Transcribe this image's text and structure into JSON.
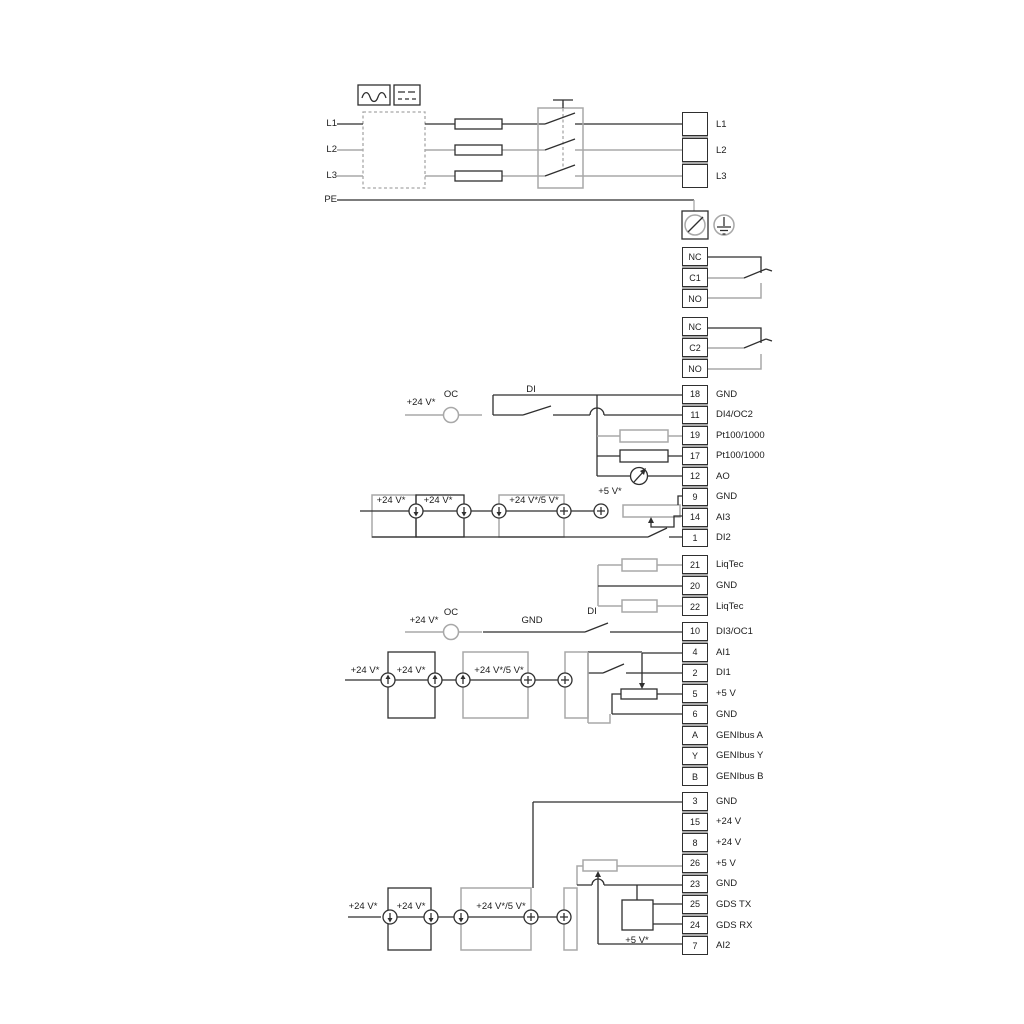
{
  "colors": {
    "line_dark": "#2f2f2f",
    "line_gray": "#a8a8a8"
  },
  "labels": {
    "v24": "+24 V*",
    "v24_5": "+24 V*/5 V*",
    "v5": "+5 V*",
    "oc": "OC",
    "di": "DI",
    "gnd": "GND"
  },
  "power": {
    "inputs": [
      "L1",
      "L2",
      "L3",
      "PE"
    ],
    "outputs": [
      "L1",
      "L2",
      "L3"
    ]
  },
  "relay1": {
    "terminals": [
      "NC",
      "C1",
      "NO"
    ]
  },
  "relay2": {
    "terminals": [
      "NC",
      "C2",
      "NO"
    ]
  },
  "group_a": {
    "terminals": [
      {
        "num": "18",
        "label": "GND"
      },
      {
        "num": "11",
        "label": "DI4/OC2"
      },
      {
        "num": "19",
        "label": "Pt100/1000"
      },
      {
        "num": "17",
        "label": "Pt100/1000"
      },
      {
        "num": "12",
        "label": "AO"
      },
      {
        "num": "9",
        "label": "GND"
      },
      {
        "num": "14",
        "label": "AI3"
      },
      {
        "num": "1",
        "label": "DI2"
      }
    ]
  },
  "group_liqtec": {
    "terminals": [
      {
        "num": "21",
        "label": "LiqTec"
      },
      {
        "num": "20",
        "label": "GND"
      },
      {
        "num": "22",
        "label": "LiqTec"
      }
    ]
  },
  "group_b": {
    "terminals": [
      {
        "num": "10",
        "label": "DI3/OC1"
      },
      {
        "num": "4",
        "label": "AI1"
      },
      {
        "num": "2",
        "label": "DI1"
      },
      {
        "num": "5",
        "label": "+5 V"
      },
      {
        "num": "6",
        "label": "GND"
      },
      {
        "num": "A",
        "label": "GENIbus A"
      },
      {
        "num": "Y",
        "label": "GENIbus Y"
      },
      {
        "num": "B",
        "label": "GENIbus B"
      }
    ]
  },
  "group_c": {
    "terminals": [
      {
        "num": "3",
        "label": "GND"
      },
      {
        "num": "15",
        "label": "+24 V"
      },
      {
        "num": "8",
        "label": "+24 V"
      },
      {
        "num": "26",
        "label": "+5 V"
      },
      {
        "num": "23",
        "label": "GND"
      },
      {
        "num": "25",
        "label": "GDS TX"
      },
      {
        "num": "24",
        "label": "GDS RX"
      },
      {
        "num": "7",
        "label": "AI2"
      }
    ]
  }
}
